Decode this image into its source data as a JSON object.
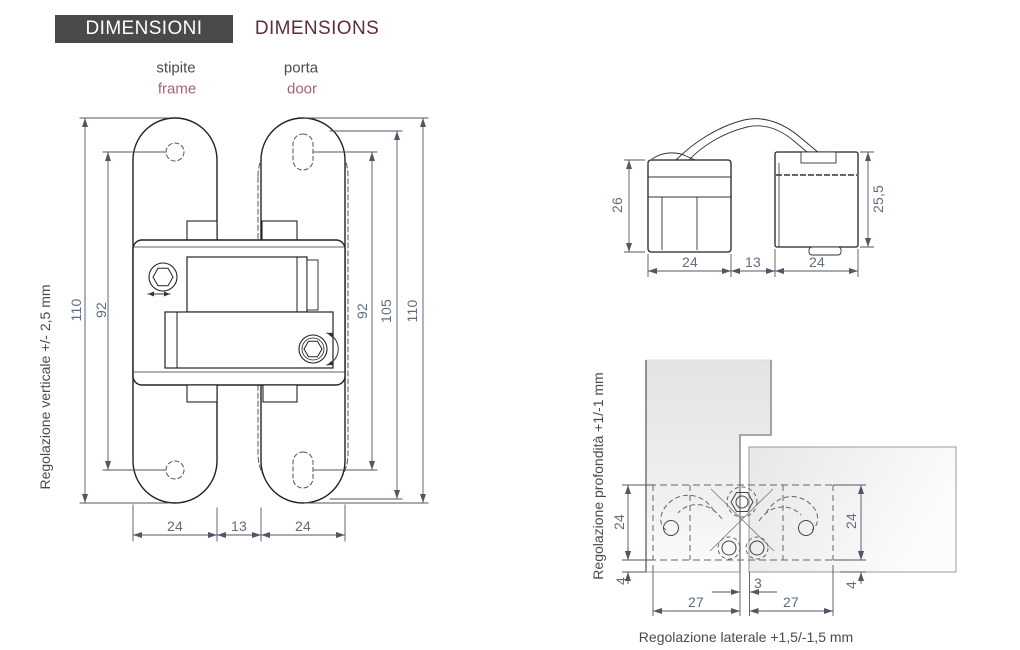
{
  "header": {
    "title_it": "DIMENSIONI",
    "title_en": "DIMENSIONS"
  },
  "legend": {
    "stipite": "stipite",
    "frame": "frame",
    "porta": "porta",
    "door": "door"
  },
  "front_view": {
    "adjust_label": "Regolazione verticale +/- 2,5 mm",
    "dim_left_outer": "110",
    "dim_left_inner": "92",
    "dim_right_inner": "92",
    "dim_right_mid": "105",
    "dim_right_outer": "110",
    "dim_frame_width": "24",
    "dim_gap": "13",
    "dim_door_width": "24"
  },
  "side_view": {
    "dim_left_height": "26",
    "dim_right_height": "25,5",
    "dim_frame_width": "24",
    "dim_gap": "13",
    "dim_door_width": "24"
  },
  "top_view": {
    "depth_label": "Regolazione profondità +1/-1 mm",
    "lateral_label": "Regolazione laterale +1,5/-1,5 mm",
    "dim_left_depth": "24",
    "dim_left_offset": "4",
    "dim_right_depth": "24",
    "dim_right_offset": "4",
    "dim_gap": "3",
    "dim_left_width": "27",
    "dim_right_width": "27"
  },
  "colors": {
    "header_bg": "#4a4a4a",
    "maroon": "#5e2d3a",
    "rose": "#a4636e",
    "dim_text": "#5d6e7d",
    "line": "#222222"
  }
}
